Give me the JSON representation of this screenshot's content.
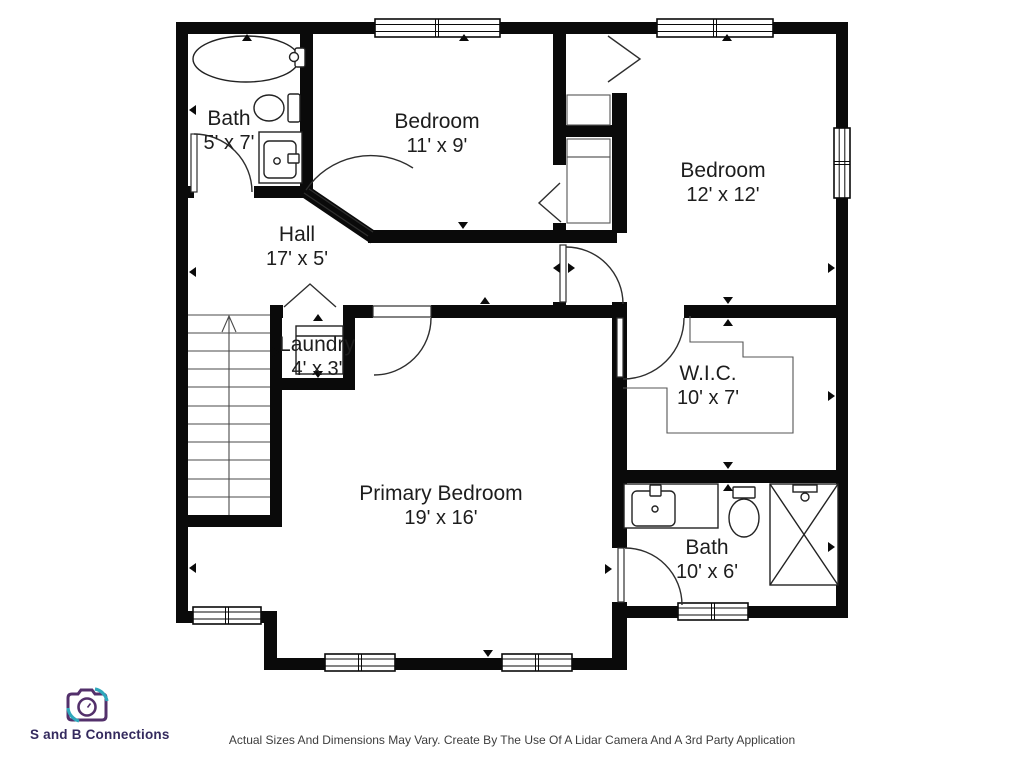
{
  "rooms": [
    {
      "name": "Bath",
      "dims": "5' x 7'"
    },
    {
      "name": "Bedroom",
      "dims": "11' x 9'"
    },
    {
      "name": "Bedroom",
      "dims": "12' x 12'"
    },
    {
      "name": "Hall",
      "dims": "17' x 5'"
    },
    {
      "name": "Laundry",
      "dims": "4' x 3'"
    },
    {
      "name": "W.I.C.",
      "dims": "10' x 7'"
    },
    {
      "name": "Primary Bedroom",
      "dims": "19' x 16'"
    },
    {
      "name": "Bath",
      "dims": "10' x 6'"
    }
  ],
  "branding": {
    "company": "S and B Connections",
    "logo_icon": "camera-icon",
    "accent_purple": "#53306b",
    "accent_teal": "#2fa8bc",
    "text_color": "#342a5e"
  },
  "footer": {
    "disclaimer": "Actual Sizes And Dimensions May Vary. Create By The Use Of A Lidar Camera And A 3rd Party Application"
  },
  "plan": {
    "wall_color": "#0a0a0a",
    "line_color": "#333333",
    "background": "#ffffff",
    "fixtures": [
      "bathtub-icon",
      "toilet-icon",
      "sink-icon",
      "shower-icon",
      "washer-icon",
      "stairs-up-icon",
      "closet-shelf-icon",
      "window-symbol",
      "door-swing"
    ]
  }
}
